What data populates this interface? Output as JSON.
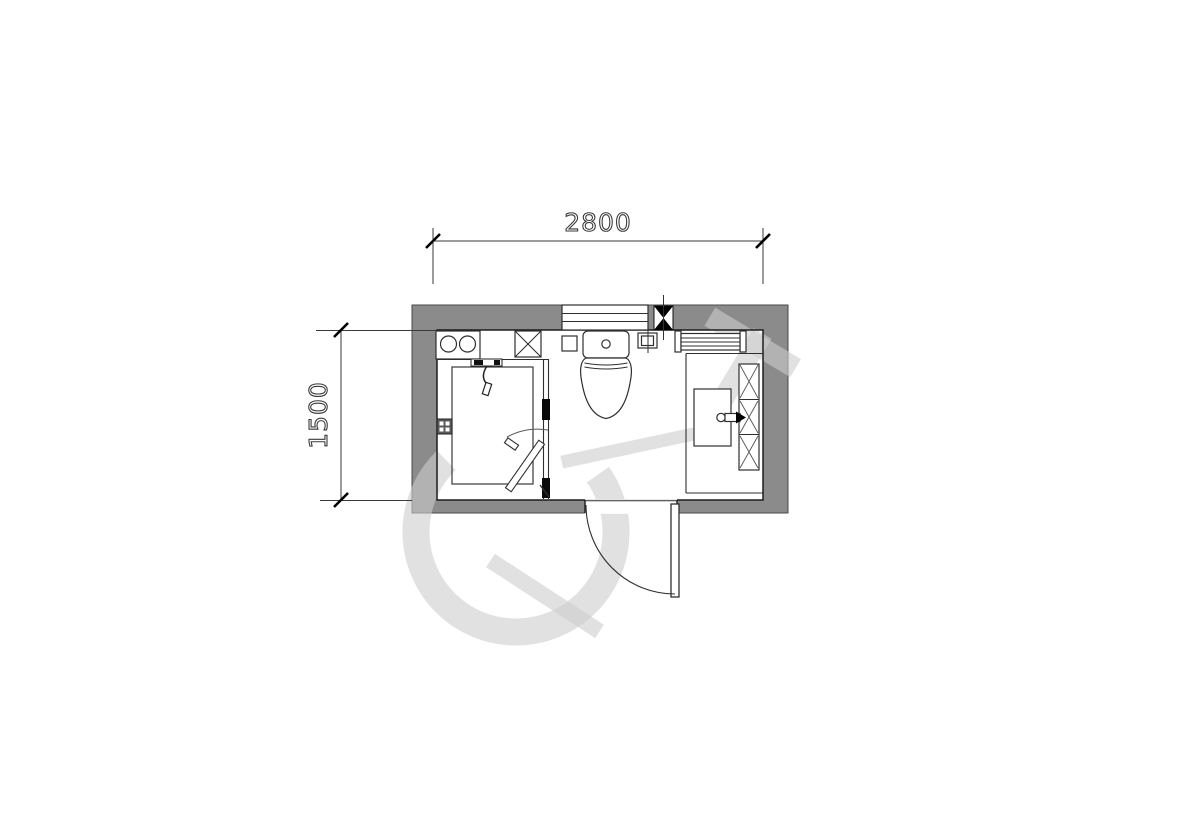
{
  "floor_plan": {
    "dimensions": {
      "width": "2800",
      "height": "1500"
    },
    "colors": {
      "background": "#ffffff",
      "wall_fill": "#8b8b8b",
      "linework": "#2f2f2f",
      "dimension_text": "#3a3a3a",
      "column_marker": "#000000",
      "watermark": "rgba(205,205,205,0.6)"
    },
    "elements": [
      {
        "icon": "window-icon"
      },
      {
        "icon": "column-marker-icon"
      },
      {
        "icon": "water-heater-icon"
      },
      {
        "icon": "pipe-shaft-icon"
      },
      {
        "icon": "shower-mixer-icon"
      },
      {
        "icon": "shower-tray-icon"
      },
      {
        "icon": "shower-door-icon"
      },
      {
        "icon": "floor-drain-icon"
      },
      {
        "icon": "toilet-icon"
      },
      {
        "icon": "water-point-icon"
      },
      {
        "icon": "towel-rack-icon"
      },
      {
        "icon": "vanity-counter-icon"
      },
      {
        "icon": "sink-icon"
      },
      {
        "icon": "faucet-icon"
      },
      {
        "icon": "mirror-cabinet-icon"
      },
      {
        "icon": "entry-door-icon"
      }
    ]
  }
}
